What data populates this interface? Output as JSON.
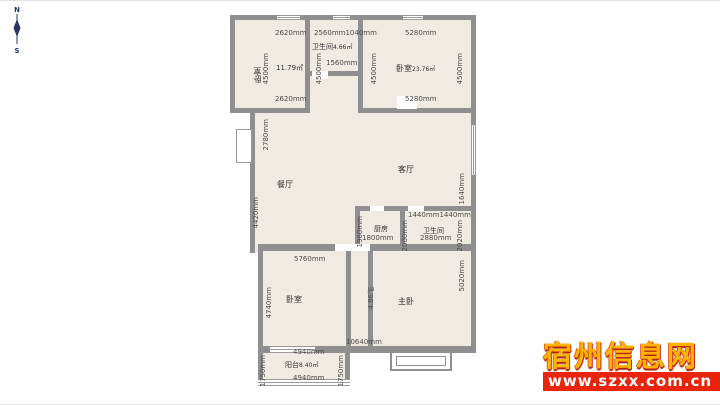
{
  "compass": {
    "north": "N",
    "south": "S"
  },
  "watermark": {
    "site_name": "宿州信息网",
    "url": "www.szxx.com.cn"
  },
  "plan": {
    "bedroom_tl": {
      "name": "卧室",
      "area": "11.79㎡",
      "dim_top": "2620mm",
      "dim_bottom": "2620mm",
      "dim_left": "4500mm",
      "dim_right": "4500mm"
    },
    "bath_top": {
      "name": "卫生间",
      "area": "4.66㎡",
      "dim_top_left": "2560mm",
      "dim_top_right": "1040mm",
      "dim_inner": "1560mm"
    },
    "bedroom_tr": {
      "name": "卧室",
      "area": "23.76㎡",
      "dim_top": "5280mm",
      "dim_bottom": "5280mm",
      "dim_left": "4500mm",
      "dim_right": "4500mm"
    },
    "dining": {
      "name": "餐厅",
      "dim_upper_left": "2780mm",
      "dim_lower_left": "4420mm"
    },
    "living": {
      "name": "客厅",
      "dim_right": "1640mm"
    },
    "kitchen": {
      "name": "厨房",
      "dim_left": "1960mm",
      "dim_right": "2000mm",
      "dim_bottom": "1800mm"
    },
    "bath_mid": {
      "name": "卫生间",
      "dim_top_left": "1440mm",
      "dim_top_right": "1440mm",
      "dim_bottom": "2880mm",
      "dim_right": "2020mm"
    },
    "bedroom_bl": {
      "name": "卧室",
      "dim_top": "5760mm",
      "dim_left": "4740mm"
    },
    "hallway": {
      "area": "4.86㎡",
      "dim_bottom": "10640mm"
    },
    "master": {
      "name": "主卧",
      "dim_right": "5020mm"
    },
    "balcony": {
      "name": "阳台",
      "area": "8.40㎡",
      "dim_top": "4940mm",
      "dim_bottom": "4940mm",
      "dim_left": "1750mm",
      "dim_right": "1750mm"
    }
  },
  "colors": {
    "wall": "#8f8f8f",
    "room_fill": "#f0ebe2",
    "dim_text": "#4a4a4a",
    "watermark_text": "#ffb400",
    "watermark_bar": "#e8240a"
  }
}
